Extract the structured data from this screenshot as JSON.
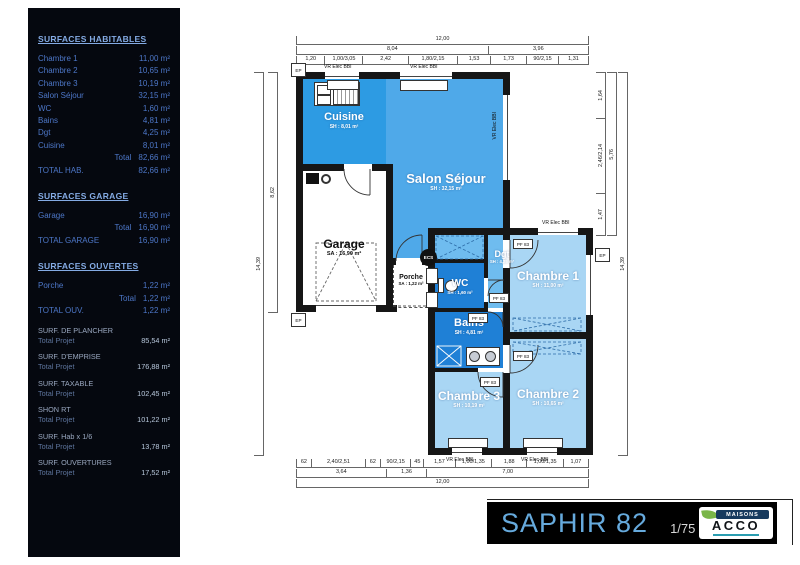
{
  "sidebar": {
    "sections": [
      {
        "title": "SURFACES HABITABLES",
        "rows": [
          {
            "l": "Chambre 1",
            "v": "11,00 m²"
          },
          {
            "l": "Chambre 2",
            "v": "10,65 m²"
          },
          {
            "l": "Chambre 3",
            "v": "10,19 m²"
          },
          {
            "l": "Salon Séjour",
            "v": "32,15 m²"
          },
          {
            "l": "WC",
            "v": "1,60 m²"
          },
          {
            "l": "Bains",
            "v": "4,81 m²"
          },
          {
            "l": "Dgt",
            "v": "4,25 m²"
          },
          {
            "l": "Cuisine",
            "v": "8,01 m²"
          },
          {
            "l": "Total",
            "v": "82,66 m²",
            "r": true
          },
          {
            "l": "TOTAL HAB.",
            "v": "82,66 m²"
          }
        ]
      },
      {
        "title": "SURFACES GARAGE",
        "rows": [
          {
            "l": "Garage",
            "v": "16,90 m²"
          },
          {
            "l": "Total",
            "v": "16,90 m²",
            "r": true
          },
          {
            "l": "TOTAL GARAGE",
            "v": "16,90 m²"
          }
        ]
      },
      {
        "title": "SURFACES OUVERTES",
        "rows": [
          {
            "l": "Porche",
            "v": "1,22 m²"
          },
          {
            "l": "Total",
            "v": "1,22 m²",
            "r": true
          },
          {
            "l": "TOTAL OUV.",
            "v": "1,22 m²"
          }
        ]
      }
    ],
    "project": [
      {
        "h": "SURF. DE PLANCHER",
        "l": "Total Projet",
        "v": "85,54 m²"
      },
      {
        "h": "SURF. D'EMPRISE",
        "l": "Total Projet",
        "v": "176,88 m²"
      },
      {
        "h": "SURF. TAXABLE",
        "l": "Total Projet",
        "v": "102,45 m²"
      },
      {
        "h": "SHON RT",
        "l": "Total Projet",
        "v": "101,22 m²"
      },
      {
        "h": "SURF. Hab x 1/6",
        "l": "Total Projet",
        "v": "13,78 m²"
      },
      {
        "h": "SURF. OUVERTURES",
        "l": "Total Projet",
        "v": "17,52 m²"
      }
    ]
  },
  "plan": {
    "rooms": {
      "cuisine": {
        "name": "Cuisine",
        "area": "SH : 8,01 m²"
      },
      "salon": {
        "name": "Salon Séjour",
        "area": "SH : 32,15 m²"
      },
      "garage": {
        "name": "Garage",
        "area": "SA : 16,90 m²"
      },
      "porche": {
        "name": "Porche",
        "area": "SA : 1,22 m²"
      },
      "wc": {
        "name": "WC",
        "area": "SH : 1,60 m²"
      },
      "dgt": {
        "name": "Dgt",
        "area": "SH : 4,25 m²"
      },
      "bains": {
        "name": "Bains",
        "area": "SH : 4,81 m²"
      },
      "ch1": {
        "name": "Chambre 1",
        "area": "SH : 11,00 m²"
      },
      "ch2": {
        "name": "Chambre 2",
        "area": "SH : 10,65 m²"
      },
      "ch3": {
        "name": "Chambre 3",
        "area": "SH : 10,19 m²"
      }
    },
    "labels": {
      "vr": "VR Elec BBI",
      "pf": "PF 83",
      "ep": "EP",
      "ecs": "ECS"
    },
    "dims": {
      "top1": [
        {
          "t": "12,00",
          "w": 12
        }
      ],
      "top2": [
        {
          "t": "8,04",
          "w": 8.04
        },
        {
          "t": "3,96",
          "w": 3.96
        }
      ],
      "top3": [
        {
          "t": "1,20",
          "w": 1.2
        },
        {
          "t": "1,00/3,05",
          "w": 1.0
        },
        {
          "t": "2,42",
          "w": 2.42
        },
        {
          "t": "1,80/2,15",
          "w": 1.8
        },
        {
          "t": "1,53",
          "w": 1.53
        },
        {
          "t": "1,73",
          "w": 1.73
        },
        {
          "t": "90/2,15",
          "w": 0.9
        },
        {
          "t": "1,31",
          "w": 1.31
        }
      ],
      "bot1": [
        {
          "t": "62",
          "w": 0.62
        },
        {
          "t": "2,40/2,51",
          "w": 2.4
        },
        {
          "t": "62",
          "w": 0.62
        },
        {
          "t": "90/2,15",
          "w": 0.9
        },
        {
          "t": "45",
          "w": 0.45
        },
        {
          "t": "1,57",
          "w": 1.57
        },
        {
          "t": "1,00/1,35",
          "w": 1.0
        },
        {
          "t": "1,88",
          "w": 1.88
        },
        {
          "t": "1,00/1,35",
          "w": 1.0
        },
        {
          "t": "1,07",
          "w": 1.07
        }
      ],
      "bot2": [
        {
          "t": "3,64",
          "w": 3.64
        },
        {
          "t": "1,36",
          "w": 1.36
        },
        {
          "t": "7,00",
          "w": 7.0
        }
      ],
      "bot3": [
        {
          "t": "12,00",
          "w": 12
        }
      ],
      "left_outer": [
        {
          "t": "14,39",
          "w": 1
        }
      ],
      "left_inner": [
        {
          "t": "8,62",
          "w": 1
        }
      ],
      "right_inner": [
        {
          "t": "1,64",
          "w": 1.64
        },
        {
          "t": "2,46/2,14",
          "w": 2.46
        },
        {
          "t": "1,47",
          "w": 1.47
        }
      ],
      "right_mid": [
        {
          "t": "5,76",
          "w": 1
        }
      ],
      "right_outer": [
        {
          "t": "14,39",
          "w": 1
        }
      ]
    },
    "colors": {
      "cuisine": "#2D9BE3",
      "salon": "#4FA9E9",
      "hall": "#6FBCEF",
      "wet_rooms": "#1F80D6",
      "bedrooms": "#A9D6F4",
      "walls": "#161616"
    }
  },
  "titleblock": {
    "title": "SAPHIR 82",
    "scale": "1/75",
    "logo_top": "MAISONS",
    "logo_main": "ACCO",
    "bar_bg": "#000000",
    "title_color": "#66AADD"
  }
}
